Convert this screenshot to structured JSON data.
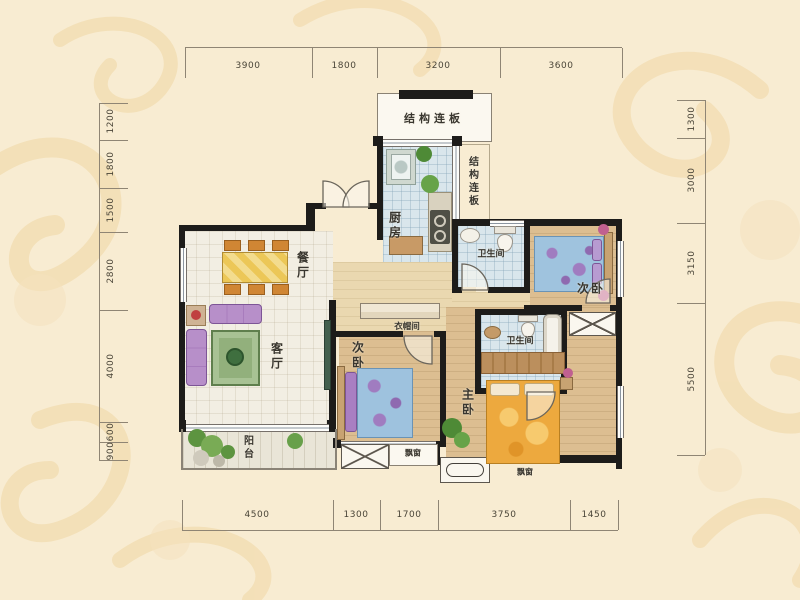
{
  "plan_type": "apartment-floor-plan",
  "rooms": {
    "structure_top": "结构连板",
    "structure_side": "结构连板",
    "kitchen": "厨房",
    "bath_top": "卫生间",
    "bedroom_top_right": "次卧",
    "dining": "餐厅",
    "living": "客厅",
    "cloakroom": "衣帽间",
    "bedroom_middle": "次卧",
    "bath_master": "卫生间",
    "master_bedroom": "主卧",
    "balcony": "阳台",
    "bay_window_1": "飘窗",
    "bay_window_2": "飘窗"
  },
  "dimensions": {
    "top": [
      "3900",
      "1800",
      "3200",
      "3600"
    ],
    "bottom": [
      "4500",
      "1300",
      "1700",
      "3750",
      "1450"
    ],
    "left": [
      "1200",
      "1800",
      "1500",
      "2800",
      "4000",
      "600",
      "900"
    ],
    "right": [
      "1300",
      "3000",
      "3150",
      "5500"
    ]
  },
  "colors": {
    "background": "#f8ecd2",
    "damask_pattern": "#f3dfb6",
    "wall": "#1d1c1a",
    "wood_floor": "#dcbe91",
    "tile_floor": "#d9e6ec",
    "sofa_purple": "#b78fc9",
    "bed_blue": "#9fc3de",
    "bed_orange": "#eda93e",
    "dining_orange": "#d08634",
    "rug_green": "#92b07c"
  }
}
